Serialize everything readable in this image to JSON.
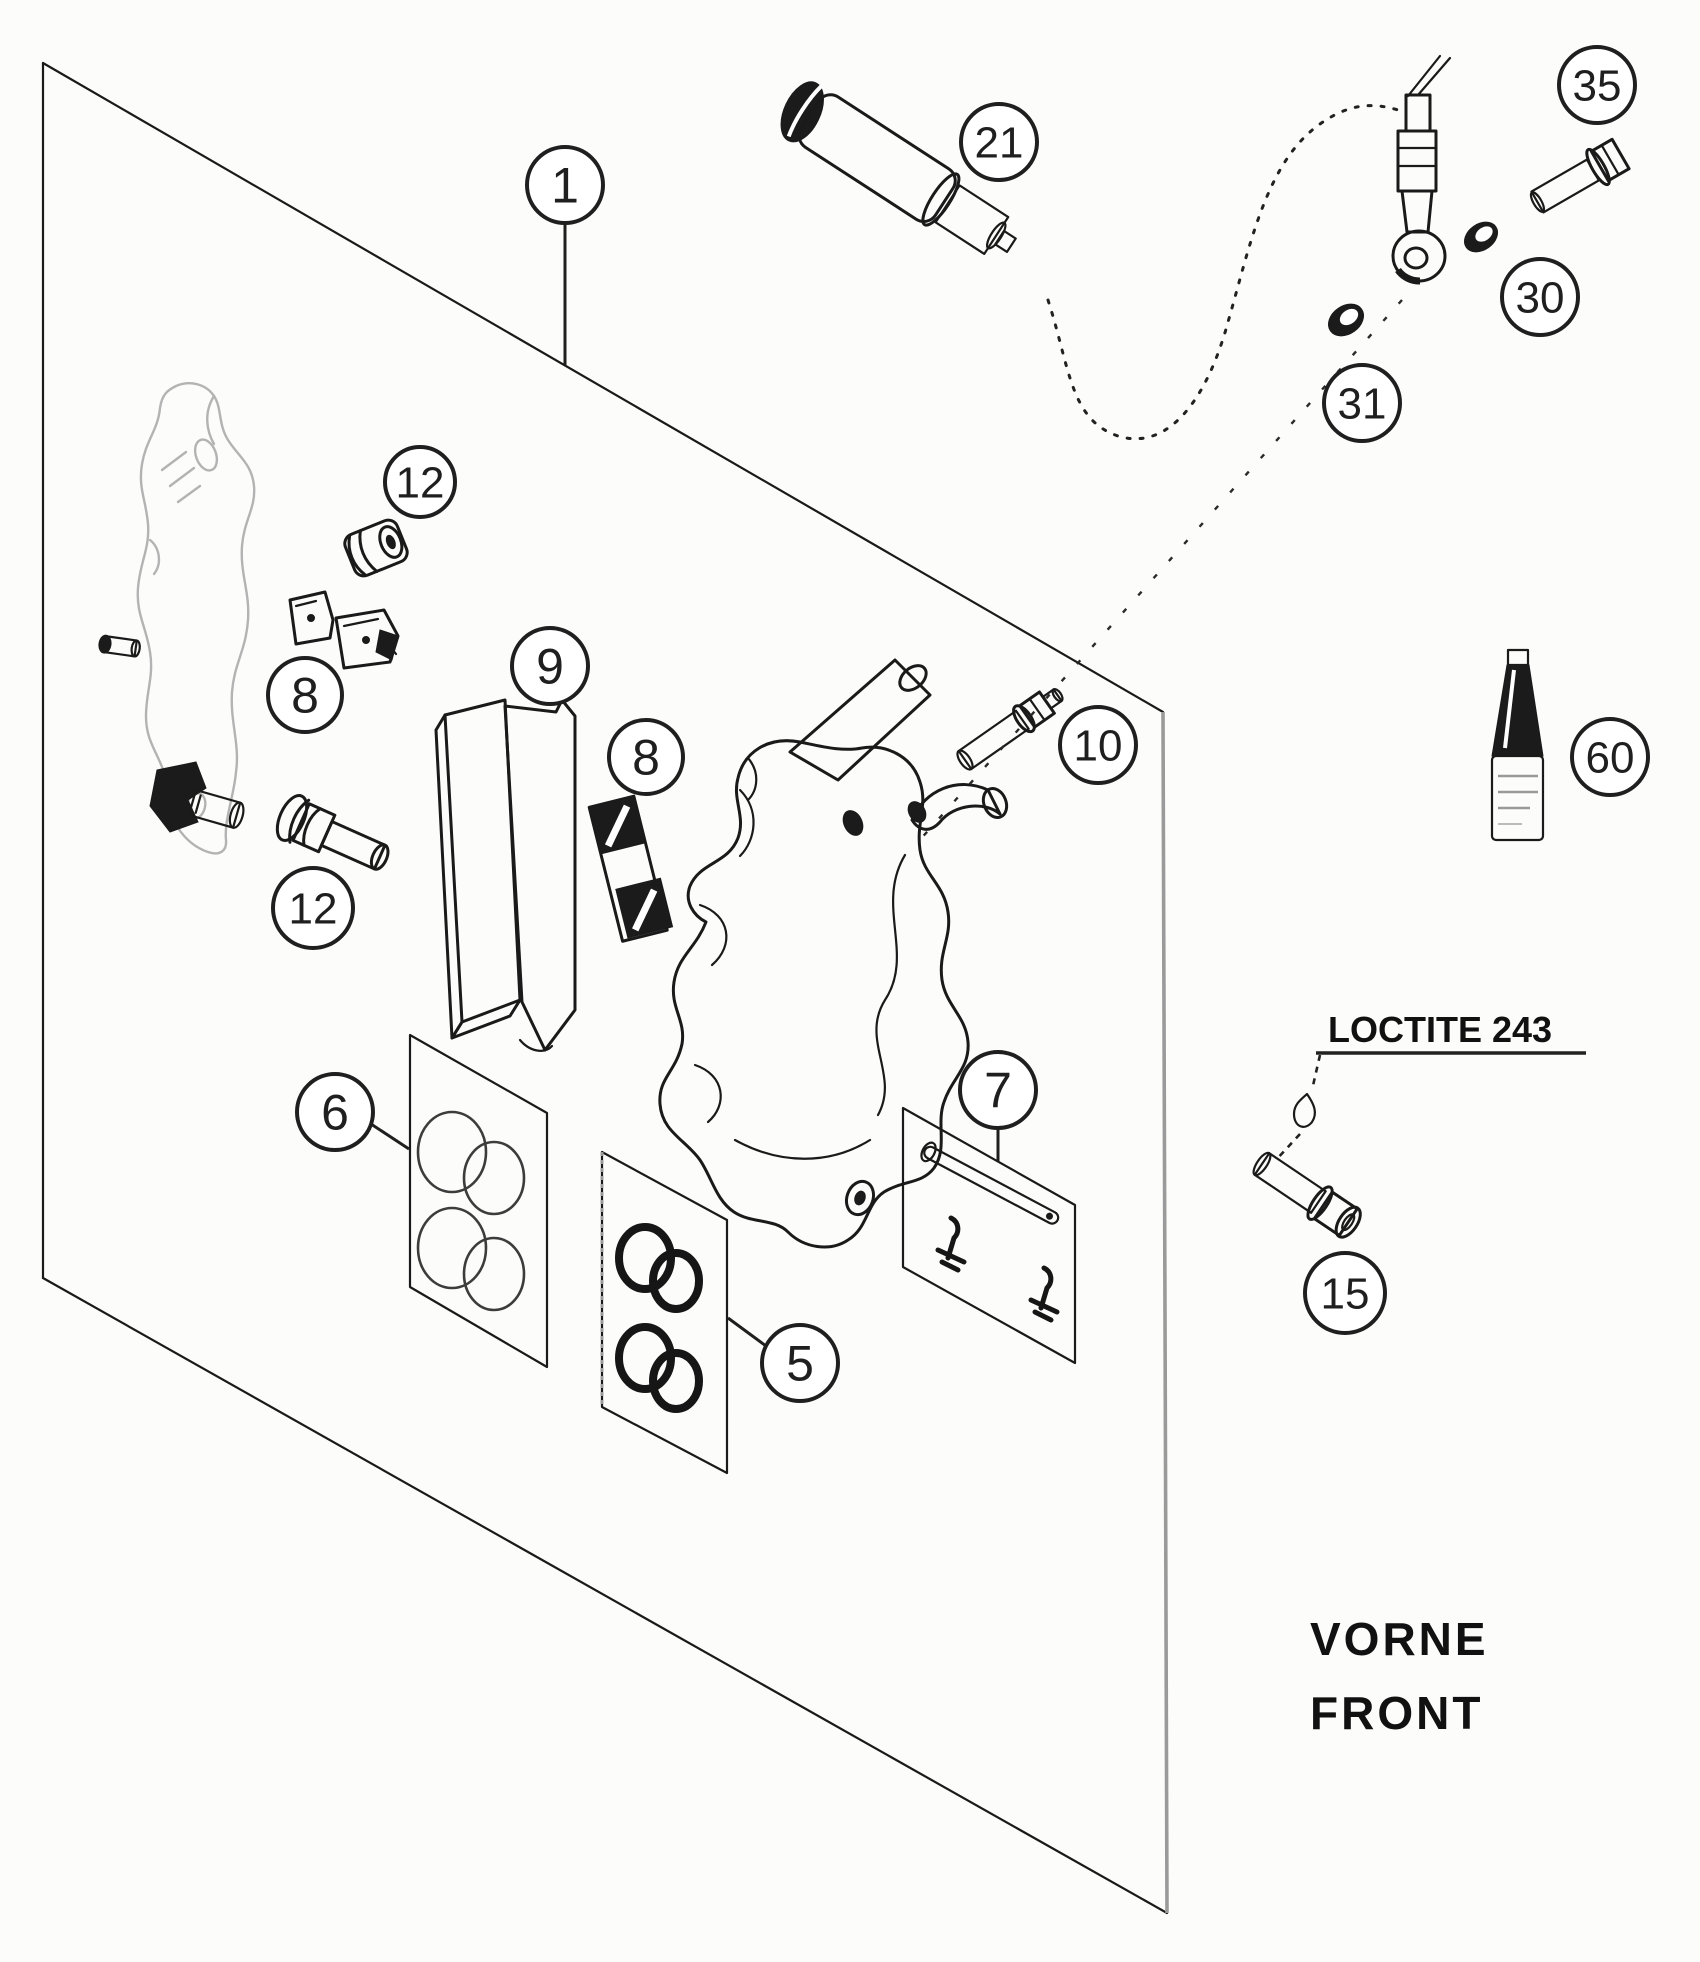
{
  "canvas": {
    "width": 1700,
    "height": 1962,
    "background": "#fcfcfb"
  },
  "colors": {
    "line": "#1a1a1a",
    "light_line": "#b3b3b3",
    "frame_right_edge": "#9a9a9a",
    "text": "#111111"
  },
  "diagram": {
    "adhesive_note": {
      "text": "LOCTITE 243"
    },
    "orientation_label": {
      "line1": "VORNE",
      "line2": "FRONT"
    },
    "callouts": [
      {
        "id": "1",
        "label": "1",
        "x": 565,
        "y": 185,
        "r": 38,
        "leader": [
          [
            565,
            224
          ],
          [
            565,
            365
          ]
        ]
      },
      {
        "id": "21",
        "label": "21",
        "x": 999,
        "y": 142,
        "r": 38
      },
      {
        "id": "35",
        "label": "35",
        "x": 1597,
        "y": 85,
        "r": 38
      },
      {
        "id": "30",
        "label": "30",
        "x": 1540,
        "y": 297,
        "r": 38
      },
      {
        "id": "31",
        "label": "31",
        "x": 1362,
        "y": 403,
        "r": 38
      },
      {
        "id": "12-upper",
        "label": "12",
        "x": 420,
        "y": 482,
        "r": 35
      },
      {
        "id": "8-left",
        "label": "8",
        "x": 305,
        "y": 695,
        "r": 37
      },
      {
        "id": "9",
        "label": "9",
        "x": 550,
        "y": 666,
        "r": 38
      },
      {
        "id": "8-right",
        "label": "8",
        "x": 646,
        "y": 757,
        "r": 37
      },
      {
        "id": "10",
        "label": "10",
        "x": 1098,
        "y": 745,
        "r": 38
      },
      {
        "id": "12-lower",
        "label": "12",
        "x": 313,
        "y": 908,
        "r": 40
      },
      {
        "id": "60",
        "label": "60",
        "x": 1610,
        "y": 757,
        "r": 38
      },
      {
        "id": "6",
        "label": "6",
        "x": 335,
        "y": 1112,
        "r": 38,
        "leader": [
          [
            371,
            1124
          ],
          [
            409,
            1149
          ]
        ]
      },
      {
        "id": "5",
        "label": "5",
        "x": 800,
        "y": 1363,
        "r": 38,
        "leader": [
          [
            766,
            1346
          ],
          [
            728,
            1318
          ]
        ]
      },
      {
        "id": "7",
        "label": "7",
        "x": 998,
        "y": 1090,
        "r": 38,
        "leader": [
          [
            998,
            1128
          ],
          [
            998,
            1161
          ]
        ]
      },
      {
        "id": "15",
        "label": "15",
        "x": 1345,
        "y": 1293,
        "r": 40
      }
    ]
  }
}
